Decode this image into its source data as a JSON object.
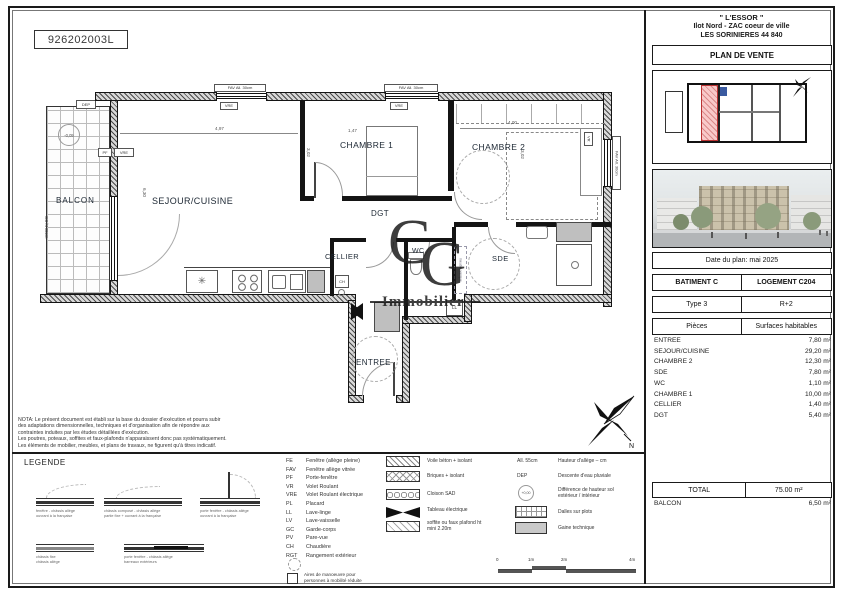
{
  "ref": "926202003L",
  "panel": {
    "project": "\" L'ESSOR \"",
    "addr1": "Ilot Nord - ZAC coeur de ville",
    "addr2": "LES SORINIERES 44 840",
    "doc_title": "PLAN DE VENTE",
    "date": "Date du plan: mai 2025",
    "batiment": "BATIMENT C",
    "logement": "LOGEMENT C204",
    "type": "Type 3",
    "etage": "R+2",
    "col_pieces": "Pièces",
    "col_surfaces": "Surfaces habitables",
    "rooms": [
      {
        "name": "ENTREE",
        "area": "7,80 m²"
      },
      {
        "name": "SEJOUR/CUISINE",
        "area": "29,20 m²"
      },
      {
        "name": "CHAMBRE 2",
        "area": "12,30 m²"
      },
      {
        "name": "SDE",
        "area": "7,80 m²"
      },
      {
        "name": "WC",
        "area": "1,10 m²"
      },
      {
        "name": "CHAMBRE 1",
        "area": "10,00 m²"
      },
      {
        "name": "CELLIER",
        "area": "1,40 m²"
      },
      {
        "name": "DGT",
        "area": "5,40 m²"
      }
    ],
    "total_label": "TOTAL",
    "total_value": "75.00 m²",
    "balcon_label": "BALCON",
    "balcon_value": "6,50 m²"
  },
  "plan": {
    "rooms": {
      "balcon": "BALCON",
      "sejour": "SEJOUR/CUISINE",
      "chambre1": "CHAMBRE 1",
      "chambre2": "CHAMBRE 2",
      "dgt": "DGT",
      "cellier": "CELLIER",
      "wc": "WC",
      "sde": "SDE",
      "entree": "ENTREE"
    },
    "ann": {
      "dep": "DEP",
      "level": "-0,05",
      "pf": "PF",
      "vre": "VRE",
      "fav": "FAV All. 30cm",
      "vr": "VR",
      "ch": "CH",
      "ll": "LL",
      "gc": "GC ht 80cm",
      "meuble": "meuble vasque",
      "north": "N"
    },
    "dims": {
      "sejour_w": "4,97",
      "sejour_h": "6,30",
      "ch1_w": "1,47",
      "ch1_h": "3,02",
      "ch2_w": "4,00",
      "ch2_h": "3,02"
    },
    "watermark": {
      "c": "C",
      "g": "G",
      "sub": "Immobilier"
    }
  },
  "nota": {
    "l1": "NOTA: Le présent document est établi sur la base du dossier d'exécution et pourra subir",
    "l2": "des adaptations dimensionnelles, techniques et d'organisation afin de répondre aux",
    "l3": "contraintes induites par les études détaillées d'exécution.",
    "l4": "Les poutres, poteaux, soffites et faux-plafonds n'apparaissent donc pas systématiquement.",
    "l5": "Les éléments de mobilier, meubles, et plans de travaux, ne figurent qu'à titres indicatif."
  },
  "legend": {
    "title": "LEGENDE",
    "abbr": [
      {
        "code": "FE",
        "label": "Fenêtre (allège pleine)"
      },
      {
        "code": "FAV",
        "label": "Fenêtre allège vitrée"
      },
      {
        "code": "PF",
        "label": "Porte-fenêtre"
      },
      {
        "code": "VR",
        "label": "Volet Roulant"
      },
      {
        "code": "VRE",
        "label": "Volet Roulant électrique"
      },
      {
        "code": "PL",
        "label": "Placard"
      },
      {
        "code": "LL",
        "label": "Lave-linge"
      },
      {
        "code": "LV",
        "label": "Lave-vaisselle"
      },
      {
        "code": "GC",
        "label": "Garde-corps"
      },
      {
        "code": "PV",
        "label": "Pare-vue"
      },
      {
        "code": "CH",
        "label": "Chaudière"
      },
      {
        "code": "RGT",
        "label": "Rangement extérieur"
      }
    ],
    "pmr1": "Aires de manoeuvre pour",
    "pmr2": "personnes à mobilité réduite",
    "glyphs": [
      {
        "l1": "fenêtre - châssis allège",
        "l2": "ouvrant à la française"
      },
      {
        "l1": "châssis composé - châssis allège",
        "l2": "partie fixe + ouvrant à la française"
      },
      {
        "l1": "porte fenêtre - châssis allège",
        "l2": "ouvrant à la française"
      },
      {
        "l1": "châssis fixe",
        "l2": "châssis allège"
      },
      {
        "l1": "porte fenêtre - châssis allège",
        "l2": "barreaux extérieurs"
      }
    ],
    "materials": [
      {
        "label": "Voile béton + isolant",
        "label2": ""
      },
      {
        "label": "Briques + isolant",
        "label2": ""
      },
      {
        "label": "Cloison SAD",
        "label2": ""
      },
      {
        "label": "Tableau électrique",
        "label2": ""
      },
      {
        "label": "soffite ou faux plafond ht",
        "label2": "mini 2.20m"
      }
    ],
    "symbols": [
      {
        "code": "All. 55cm",
        "label": "Hauteur d'allège – cm",
        "label2": ""
      },
      {
        "code": "DEP",
        "label": "Descente d'eau pluviale",
        "label2": ""
      },
      {
        "code": "+0,00",
        "label": "Différence de hauteur sol",
        "label2": "extérieur / intérieur"
      },
      {
        "code": "",
        "label": "Dalles sur plots",
        "label2": ""
      },
      {
        "code": "",
        "label": "Gaine technique",
        "label2": ""
      }
    ],
    "scale": {
      "t0": "0",
      "t1": "1m",
      "t2": "2m",
      "t3": "4m"
    }
  }
}
